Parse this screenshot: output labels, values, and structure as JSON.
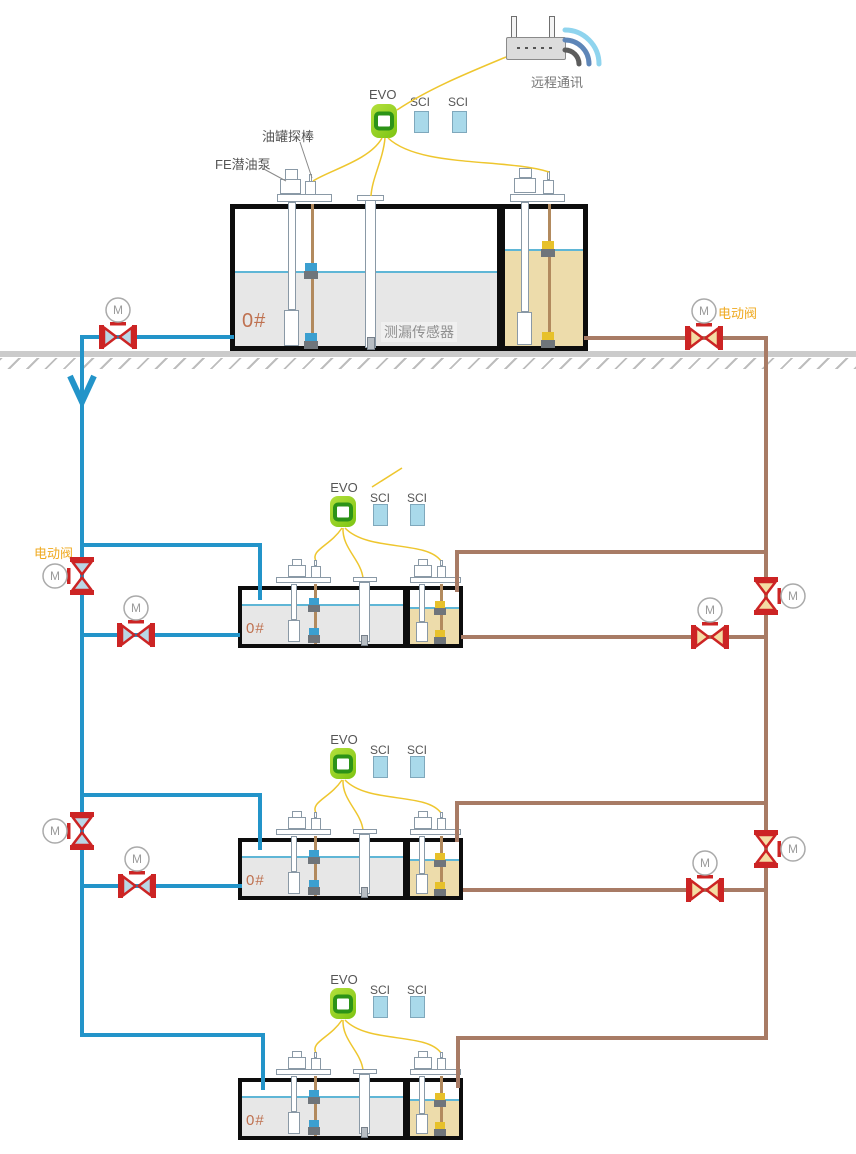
{
  "palette": {
    "pipe_blue": "#2394c9",
    "pipe_brown": "#a87b65",
    "valve_red": "#cc2424",
    "valve_fill_on_blue": "#b9d7e6",
    "valve_fill_on_brown": "#f4dda4",
    "wire_yellow": "#eec62e",
    "evo_green": "#8fcf1d",
    "evo_ring_green": "#2c9317",
    "sci_blue": "#a9d9ea",
    "fuel_gray": "#e7e7e7",
    "fuel_tan": "#eddcab",
    "liquid_line": "#5fb6d6",
    "electric_valve_label": "#efa91f",
    "fuel_grade_label": "#bf7150"
  },
  "remote_comm": {
    "label": "远程通讯"
  },
  "device_labels": {
    "evo": "EVO",
    "sci": "SCI"
  },
  "annotations": {
    "tank_probe": "油罐探棒",
    "fe_pump": "FE潜油泵",
    "leak_sensor": "测漏传感器",
    "electric_valve": "电动阀",
    "fuel_grade": "0#",
    "valve_motor": "M"
  }
}
